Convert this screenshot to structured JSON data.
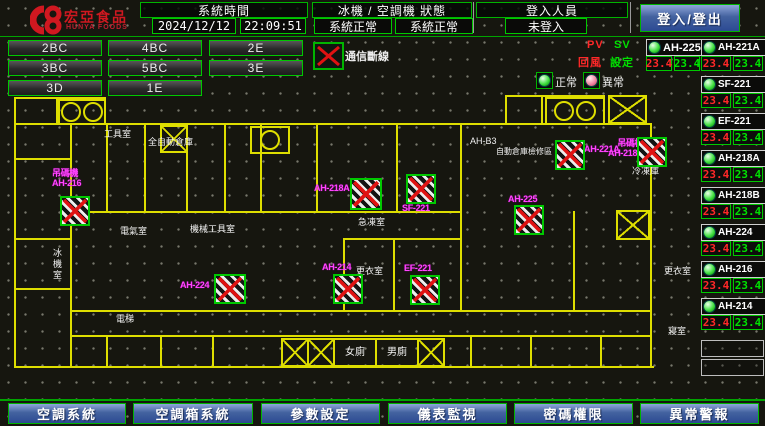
{
  "header": {
    "brand_cn": "宏亞食品",
    "brand_en": "HUNYA FOODS",
    "system_time_label": "系統時間",
    "date": "2024/12/12",
    "time": "22:09:51",
    "machine_status_label": "冰機 / 空調機 狀態",
    "chiller_status": "系統正常",
    "ahu_status": "系統正常",
    "login_label": "登入人員",
    "login_state": "未登入",
    "login_button": "登入/登出"
  },
  "floors": {
    "row1": [
      "2BC",
      "4BC",
      "2E"
    ],
    "row2": [
      "3BC",
      "5BC",
      "3E"
    ],
    "row3": [
      "3D",
      "1E"
    ]
  },
  "legend": {
    "offline_label": "通信斷線",
    "normal_label": "正常",
    "abnormal_label": "異常",
    "pv_header": "PV",
    "sv_header": "SV",
    "pv_row_label": "回風",
    "sv_row_label": "設定"
  },
  "units": [
    {
      "name": "AH-225",
      "pv": "23.4",
      "sv": "23.4"
    },
    {
      "name": "AH-221A",
      "pv": "23.4",
      "sv": "23.4"
    },
    {
      "name": "SF-221",
      "pv": "23.4",
      "sv": "23.4"
    },
    {
      "name": "EF-221",
      "pv": "23.4",
      "sv": "23.4"
    },
    {
      "name": "AH-218A",
      "pv": "23.4",
      "sv": "23.4"
    },
    {
      "name": "AH-218B",
      "pv": "23.4",
      "sv": "23.4"
    },
    {
      "name": "AH-224",
      "pv": "23.4",
      "sv": "23.4"
    },
    {
      "name": "AH-216",
      "pv": "23.4",
      "sv": "23.4"
    },
    {
      "name": "AH-214",
      "pv": "23.4",
      "sv": "23.4"
    }
  ],
  "plan": {
    "rooms": [
      "工具室",
      "全自動倉庫",
      "AH-B3",
      "自動倉庫檢修區",
      "機械工具室",
      "電氣室",
      "急凍室",
      "更衣室",
      "女廁",
      "男廁",
      "冰機室",
      "電梯",
      "冷凍庫",
      "更衣室",
      "寢室"
    ],
    "devices": [
      {
        "label1": "吊碼機",
        "label2": "AH-216"
      },
      {
        "label1": "AH-224",
        "label2": ""
      },
      {
        "label1": "AH-214",
        "label2": ""
      },
      {
        "label1": "AH-218A",
        "label2": ""
      },
      {
        "label1": "SF-221",
        "label2": ""
      },
      {
        "label1": "EF-221",
        "label2": ""
      },
      {
        "label1": "AH-225",
        "label2": ""
      },
      {
        "label1": "AH-221A",
        "label2": ""
      },
      {
        "label1": "吊碼機",
        "label2": "AH-218B"
      }
    ]
  },
  "nav": [
    "空調系統",
    "空調箱系統",
    "參數設定",
    "儀表監視",
    "密碼權限",
    "異常警報"
  ]
}
